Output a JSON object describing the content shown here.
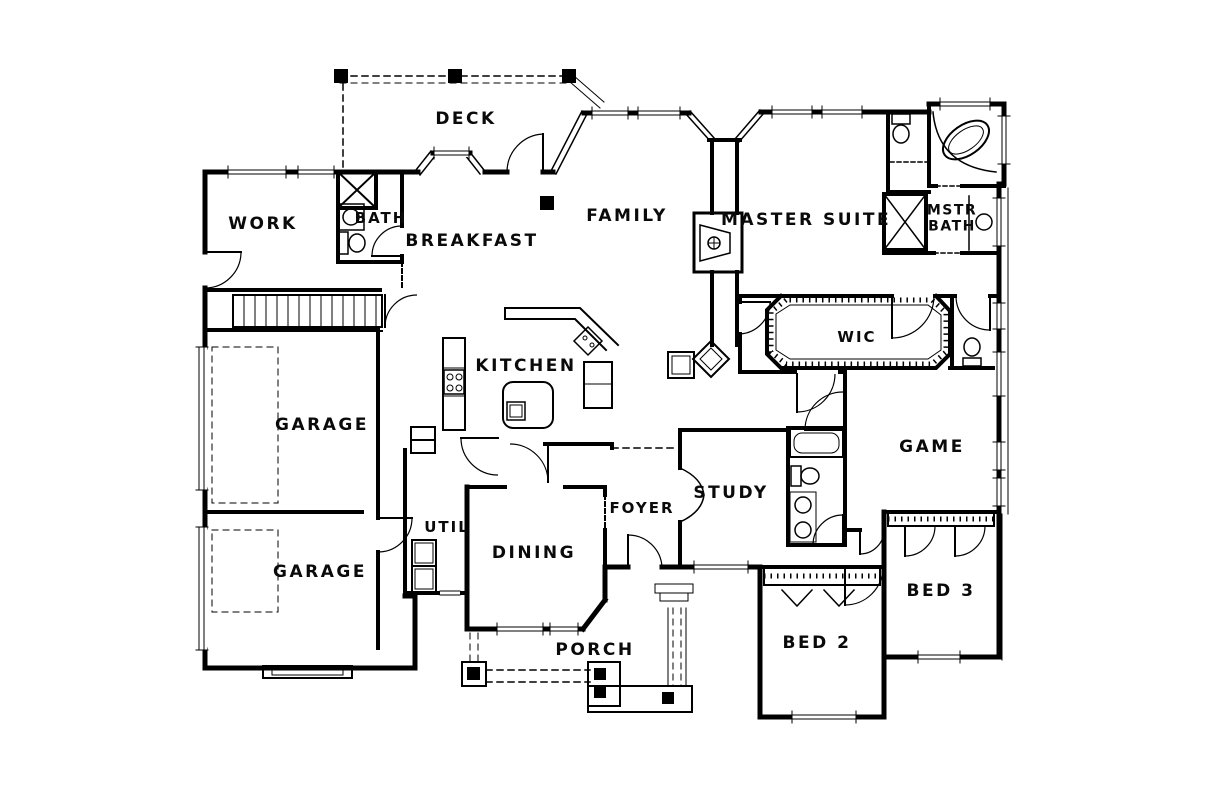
{
  "colors": {
    "background": "#ffffff",
    "line": "#000000"
  },
  "rooms": {
    "deck": "DECK",
    "work": "WORK",
    "bath": "BATH",
    "breakfast": "BREAKFAST",
    "family": "FAMILY",
    "master_suite": "MASTER SUITE",
    "mstr_bath_line1": "MSTR",
    "mstr_bath_line2": "BATH",
    "kitchen": "KITCHEN",
    "wic": "WIC",
    "garage_upper": "GARAGE",
    "game": "GAME",
    "util": "UTIL",
    "dining": "DINING",
    "foyer": "FOYER",
    "study": "STUDY",
    "garage_lower": "GARAGE",
    "porch": "PORCH",
    "bed2": "BED 2",
    "bed3": "BED 3"
  }
}
